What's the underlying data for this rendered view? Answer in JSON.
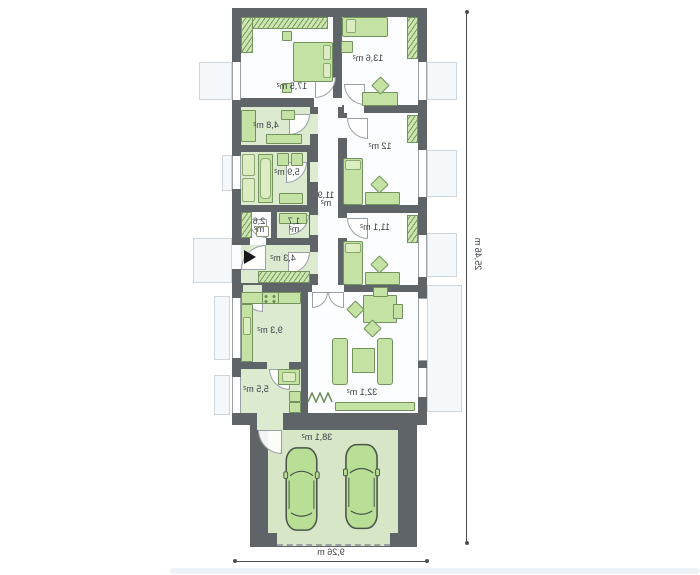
{
  "plan_title": "single-storey house floor plan with double garage",
  "dimensions": {
    "vertical": "25,46 m",
    "horizontal": "9,26 m"
  },
  "rooms": [
    {
      "name": "bedroom-1",
      "area": "17,5 m²"
    },
    {
      "name": "bedroom-2",
      "area": "13,6 m²"
    },
    {
      "name": "wardrobe",
      "area": "4,8 m²"
    },
    {
      "name": "bathroom",
      "area": "5,9 m²"
    },
    {
      "name": "corridor",
      "area_value": "11,9",
      "area_unit": "m²"
    },
    {
      "name": "bedroom-3",
      "area": "12 m²"
    },
    {
      "name": "bedroom-4",
      "area": "11,1 m²"
    },
    {
      "name": "wc",
      "area_value": "2,6",
      "area_unit": "m²"
    },
    {
      "name": "storage",
      "area_value": "1,7",
      "area_unit": "m²"
    },
    {
      "name": "entry-hall",
      "area": "4,3 m²"
    },
    {
      "name": "kitchen",
      "area": "9,3 m²"
    },
    {
      "name": "living-room",
      "area": "32,1 m²"
    },
    {
      "name": "utility-room",
      "area": "5,5 m²"
    },
    {
      "name": "garage",
      "area": "38,1 m²"
    }
  ],
  "colors": {
    "wall": "#5f6468",
    "floor-white": "#fcfdfe",
    "floor-green": "#dcead0",
    "garage-floor": "#d7e6c6",
    "furniture": "#c3e2a4",
    "furniture-border": "#72945c",
    "car": "#b9df97",
    "sill": "#f5f8fb",
    "text": "#3a3e42",
    "dim": "#4a4f53"
  }
}
